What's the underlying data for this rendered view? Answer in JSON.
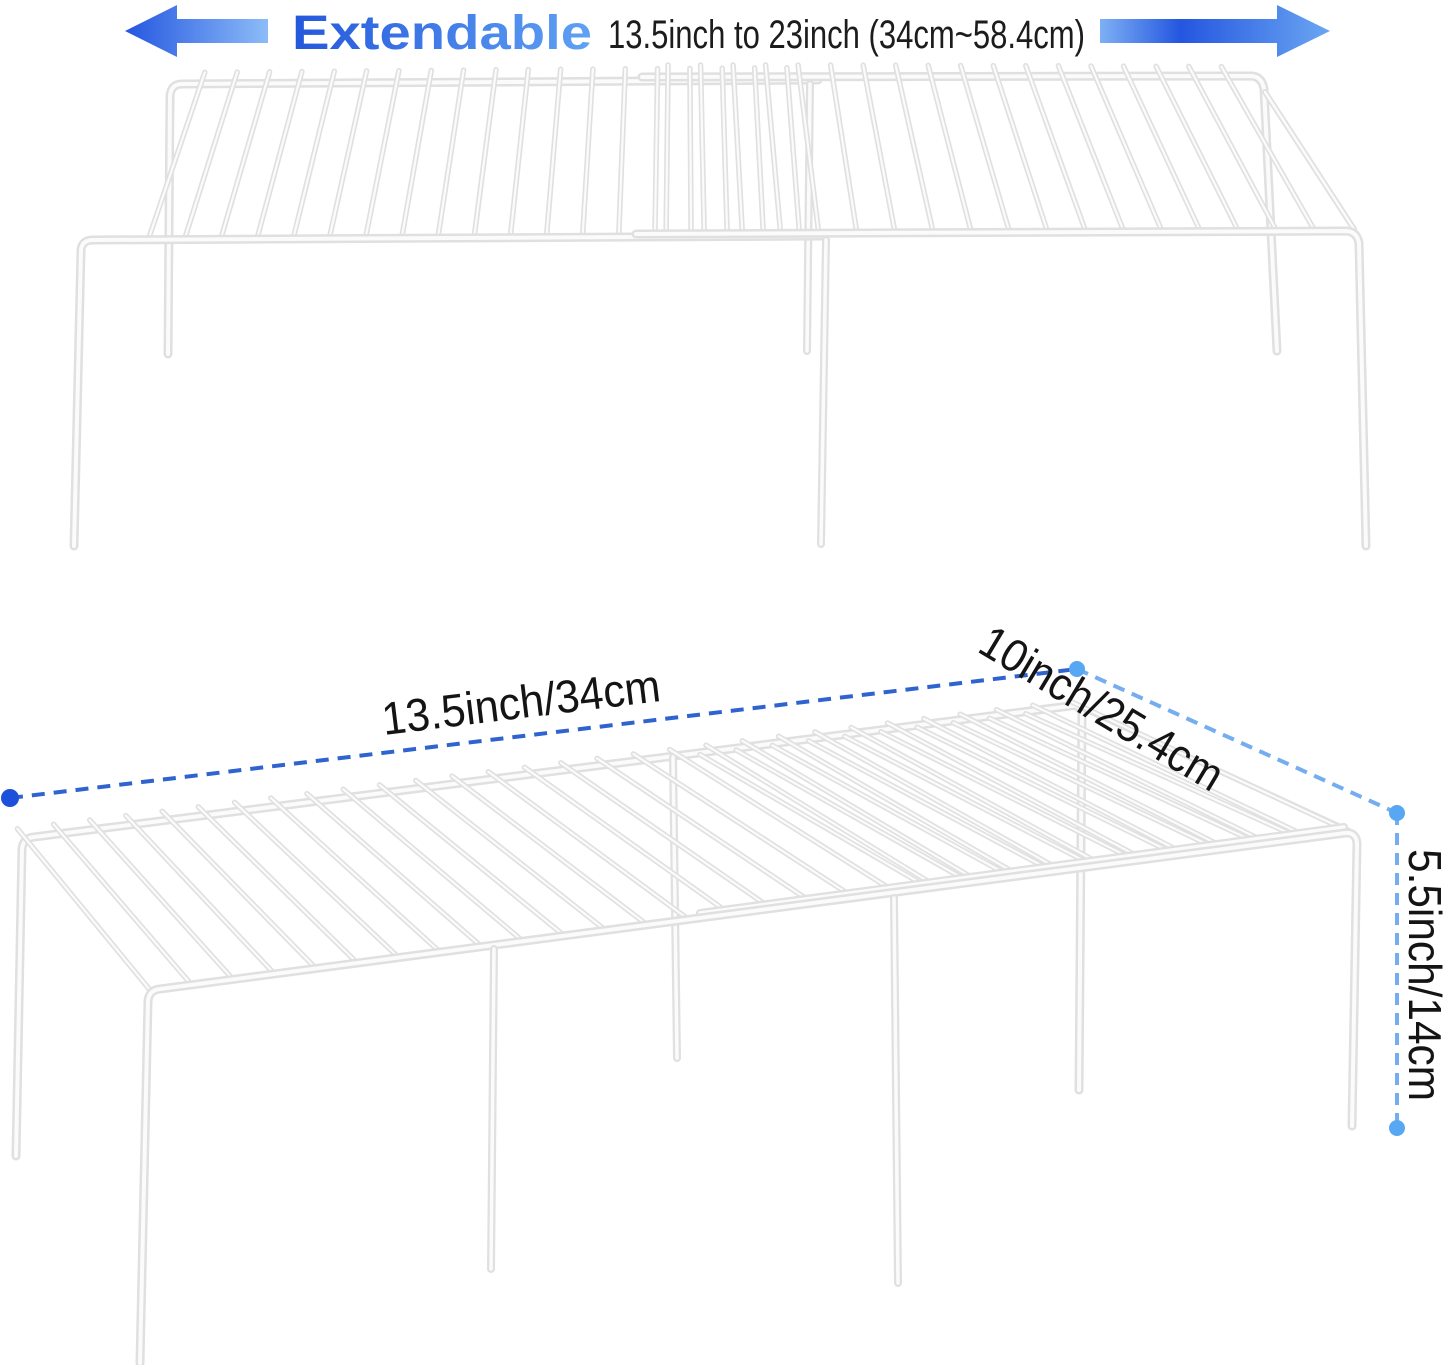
{
  "header": {
    "title": "Extendable",
    "range_text": "13.5inch to 23inch (34cm~58.4cm)",
    "left_arrow_icon": "arrow-left",
    "right_arrow_icon": "arrow-right"
  },
  "dimensions": {
    "length_label": "13.5inch/34cm",
    "depth_label": "10inch/25.4cm",
    "height_label": "5.5inch/14cm"
  },
  "colors": {
    "arrow_dark": "#2456e0",
    "arrow_light": "#8cbcf8",
    "arrow_right_edge": "#7db0f4",
    "arrow_right_mid": "#2456e0",
    "arrow_right_tip": "#6ba6f2",
    "title_gradient_start": "#2458dc",
    "title_gradient_end": "#60a2f4",
    "header_text": "#1c1c1c",
    "label_text": "#141414",
    "dim_line_primary": "#2f63cf",
    "dim_line_secondary": "#74adf0",
    "dot_primary": "#1d50da",
    "dot_secondary": "#57a7f2",
    "wire_outline": "#e0e0e0",
    "wire_highlight": "#fbfbfb"
  }
}
